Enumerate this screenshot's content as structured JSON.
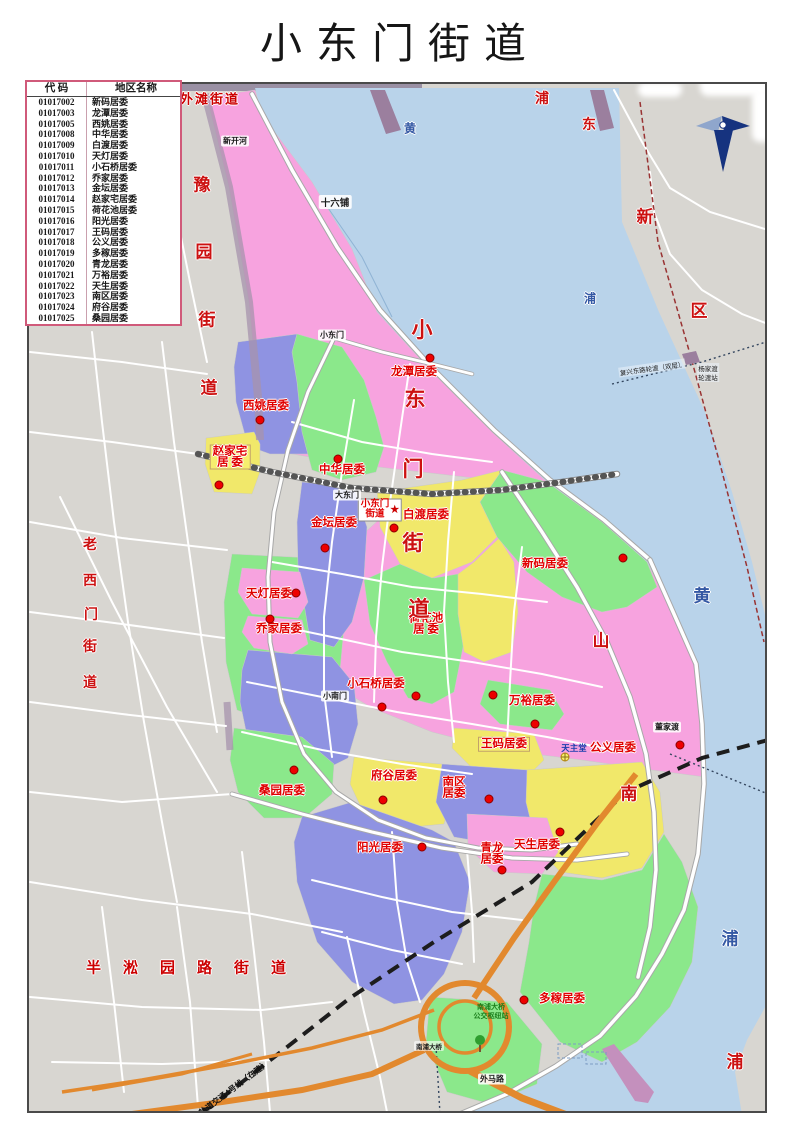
{
  "page_title": "小东门街道",
  "legend_table": {
    "headers": [
      "代 码",
      "地区名称"
    ],
    "rows": [
      [
        "01017002",
        "新码居委"
      ],
      [
        "01017003",
        "龙潭居委"
      ],
      [
        "01017005",
        "西姚居委"
      ],
      [
        "01017008",
        "中华居委"
      ],
      [
        "01017009",
        "白渡居委"
      ],
      [
        "01017010",
        "天灯居委"
      ],
      [
        "01017011",
        "小石桥居委"
      ],
      [
        "01017012",
        "乔家居委"
      ],
      [
        "01017013",
        "金坛居委"
      ],
      [
        "01017014",
        "赵家宅居委"
      ],
      [
        "01017015",
        "荷花池居委"
      ],
      [
        "01017016",
        "阳光居委"
      ],
      [
        "01017017",
        "王码居委"
      ],
      [
        "01017018",
        "公义居委"
      ],
      [
        "01017019",
        "多稼居委"
      ],
      [
        "01017020",
        "青龙居委"
      ],
      [
        "01017021",
        "万裕居委"
      ],
      [
        "01017022",
        "天生居委"
      ],
      [
        "01017023",
        "南区居委"
      ],
      [
        "01017024",
        "府谷居委"
      ],
      [
        "01017025",
        "桑园居委"
      ]
    ]
  },
  "colors": {
    "pink": "#F7A3DF",
    "green": "#8BE88B",
    "yellow": "#F1E86A",
    "purple": "#8F93E2",
    "river": "#B9D3EA",
    "land": "#D8D6D1",
    "bridge_orange": "#E2892E",
    "label_red": "#E00000",
    "river_text_blue": "#3458A4"
  },
  "map": {
    "office_label": {
      "lines": [
        "小东门",
        "街道"
      ],
      "star": "★",
      "x": 378,
      "y": 508
    },
    "districts": [
      {
        "name": "龙潭居委",
        "lines": [
          "龙潭居委"
        ],
        "x": 412,
        "y": 370,
        "dot": {
          "x": 428,
          "y": 356
        }
      },
      {
        "name": "西姚居委",
        "lines": [
          "西姚居委"
        ],
        "x": 264,
        "y": 404,
        "dot": {
          "x": 258,
          "y": 418
        }
      },
      {
        "name": "中华居委",
        "lines": [
          "中华居委"
        ],
        "x": 340,
        "y": 468,
        "dot": {
          "x": 336,
          "y": 457
        }
      },
      {
        "name": "赵家宅居委",
        "lines": [
          "赵家宅",
          "居 委"
        ],
        "x": 228,
        "y": 455,
        "boxed": true,
        "dot": {
          "x": 217,
          "y": 483
        }
      },
      {
        "name": "金坛居委",
        "lines": [
          "金坛居委"
        ],
        "x": 332,
        "y": 521,
        "dot": {
          "x": 323,
          "y": 546
        }
      },
      {
        "name": "白渡居委",
        "lines": [
          "白渡居委"
        ],
        "x": 424,
        "y": 513,
        "dot": {
          "x": 392,
          "y": 526
        }
      },
      {
        "name": "新码居委",
        "lines": [
          "新码居委"
        ],
        "x": 543,
        "y": 562,
        "dot": {
          "x": 621,
          "y": 556
        }
      },
      {
        "name": "天灯居委",
        "lines": [
          "天灯居委"
        ],
        "x": 267,
        "y": 592,
        "dot": {
          "x": 294,
          "y": 591
        }
      },
      {
        "name": "乔家居委",
        "lines": [
          "乔家居委"
        ],
        "x": 277,
        "y": 627,
        "dot": {
          "x": 268,
          "y": 617
        }
      },
      {
        "name": "荷花池居委",
        "lines": [
          "荷花池",
          "居  委"
        ],
        "x": 424,
        "y": 622,
        "dot": {
          "x": 414,
          "y": 694
        }
      },
      {
        "name": "小石桥居委",
        "lines": [
          "小石桥居委"
        ],
        "x": 374,
        "y": 682,
        "dot": {
          "x": 380,
          "y": 705
        }
      },
      {
        "name": "万裕居委",
        "lines": [
          "万裕居委"
        ],
        "x": 530,
        "y": 699,
        "dot": {
          "x": 491,
          "y": 693
        }
      },
      {
        "name": "王码居委",
        "lines": [
          "王码居委"
        ],
        "x": 502,
        "y": 742,
        "boxed": true,
        "dot": {
          "x": 533,
          "y": 722
        }
      },
      {
        "name": "公义居委",
        "lines": [
          "公义居委"
        ],
        "x": 611,
        "y": 746,
        "dot": {
          "x": 678,
          "y": 743
        }
      },
      {
        "name": "府谷居委",
        "lines": [
          "府谷居委"
        ],
        "x": 392,
        "y": 774,
        "dot": {
          "x": 381,
          "y": 798
        }
      },
      {
        "name": "南区居委",
        "lines": [
          "南区",
          "居委"
        ],
        "x": 452,
        "y": 786,
        "dot": {
          "x": 487,
          "y": 797
        }
      },
      {
        "name": "桑园居委",
        "lines": [
          "桑园居委"
        ],
        "x": 280,
        "y": 789,
        "dot": {
          "x": 292,
          "y": 768
        }
      },
      {
        "name": "阳光居委",
        "lines": [
          "阳光居委"
        ],
        "x": 378,
        "y": 846,
        "dot": {
          "x": 420,
          "y": 845
        }
      },
      {
        "name": "青龙居委",
        "lines": [
          "青龙",
          "居委"
        ],
        "x": 490,
        "y": 852,
        "dot": {
          "x": 500,
          "y": 868
        }
      },
      {
        "name": "天生居委",
        "lines": [
          "天生居委"
        ],
        "x": 535,
        "y": 843,
        "dot": {
          "x": 558,
          "y": 830
        }
      },
      {
        "name": "多稼居委",
        "lines": [
          "多稼居委"
        ],
        "x": 560,
        "y": 997,
        "dot": {
          "x": 522,
          "y": 998
        }
      }
    ],
    "big_chars": [
      {
        "c": "豫",
        "x": 200,
        "y": 181,
        "cls": "red-lg"
      },
      {
        "c": "园",
        "x": 202,
        "y": 248,
        "cls": "red-lg"
      },
      {
        "c": "街",
        "x": 205,
        "y": 316,
        "cls": "red-lg"
      },
      {
        "c": "道",
        "x": 207,
        "y": 384,
        "cls": "red-lg"
      },
      {
        "c": "老",
        "x": 88,
        "y": 542,
        "cls": "red-md"
      },
      {
        "c": "西",
        "x": 88,
        "y": 578,
        "cls": "red-md"
      },
      {
        "c": "门",
        "x": 89,
        "y": 612,
        "cls": "red-md"
      },
      {
        "c": "街",
        "x": 88,
        "y": 644,
        "cls": "red-md"
      },
      {
        "c": "道",
        "x": 88,
        "y": 680,
        "cls": "red-md"
      },
      {
        "c": "浦",
        "x": 540,
        "y": 96,
        "cls": "red-md"
      },
      {
        "c": "东",
        "x": 587,
        "y": 122,
        "cls": "red-md"
      },
      {
        "c": "新",
        "x": 643,
        "y": 213,
        "cls": "red-lg"
      },
      {
        "c": "区",
        "x": 697,
        "y": 307,
        "cls": "red-lg"
      },
      {
        "c": "浦",
        "x": 733,
        "y": 1058,
        "cls": "red-lg"
      },
      {
        "c": "小",
        "x": 420,
        "y": 327,
        "cls": "red-xl"
      },
      {
        "c": "东",
        "x": 413,
        "y": 396,
        "cls": "red-xl"
      },
      {
        "c": "门",
        "x": 411,
        "y": 466,
        "cls": "red-xl"
      },
      {
        "c": "街",
        "x": 411,
        "y": 540,
        "cls": "red-xl"
      },
      {
        "c": "道",
        "x": 417,
        "y": 606,
        "cls": "red-xl"
      },
      {
        "c": "山",
        "x": 599,
        "y": 637,
        "cls": "red-lg"
      },
      {
        "c": "南",
        "x": 627,
        "y": 790,
        "cls": "red-lg"
      },
      {
        "c": "黄",
        "x": 408,
        "y": 126,
        "cls": "blue-sm"
      },
      {
        "c": "浦",
        "x": 588,
        "y": 296,
        "cls": "blue-sm"
      },
      {
        "c": "黄",
        "x": 700,
        "y": 592,
        "cls": "blue-lg"
      },
      {
        "c": "浦",
        "x": 728,
        "y": 935,
        "cls": "blue-lg"
      }
    ],
    "labels": [
      {
        "t": "外滩街道",
        "x": 208,
        "y": 96,
        "cls": "red-h halo"
      },
      {
        "t": "半淞园路街道",
        "x": 195,
        "y": 965,
        "cls": "red-spread halo"
      },
      {
        "t": "新开河",
        "x": 233,
        "y": 139,
        "cls": "road"
      },
      {
        "t": "十六铺",
        "x": 333,
        "y": 200,
        "cls": "road road-lg"
      },
      {
        "t": "小东门",
        "x": 330,
        "y": 333,
        "cls": "road"
      },
      {
        "t": "大东门",
        "x": 345,
        "y": 493,
        "cls": "road"
      },
      {
        "t": "小南门",
        "x": 333,
        "y": 694,
        "cls": "road"
      },
      {
        "t": "董家渡",
        "x": 665,
        "y": 725,
        "cls": "road"
      },
      {
        "t": "外马路",
        "x": 490,
        "y": 1077,
        "cls": "road"
      },
      {
        "t": "南浦大桥",
        "x": 427,
        "y": 1044,
        "cls": "road road-xs"
      },
      {
        "t": "复兴东路轮渡（双层）",
        "x": 650,
        "y": 366,
        "cls": "ferry",
        "rot": -8
      },
      {
        "t": "杨家渡",
        "x": 706,
        "y": 366,
        "cls": "ferry"
      },
      {
        "t": "轮渡站",
        "x": 706,
        "y": 375,
        "cls": "ferry"
      },
      {
        "t": "轨道交通4号线（在建）",
        "x": 232,
        "y": 1086,
        "cls": "transit",
        "rot": -37
      },
      {
        "t": "天主堂",
        "x": 572,
        "y": 746,
        "cls": "poi-blue"
      },
      {
        "t": "南浦大桥",
        "x": 489,
        "y": 1005,
        "cls": "poi-green"
      },
      {
        "t": "公交枢纽站",
        "x": 489,
        "y": 1014,
        "cls": "poi-green"
      }
    ]
  }
}
